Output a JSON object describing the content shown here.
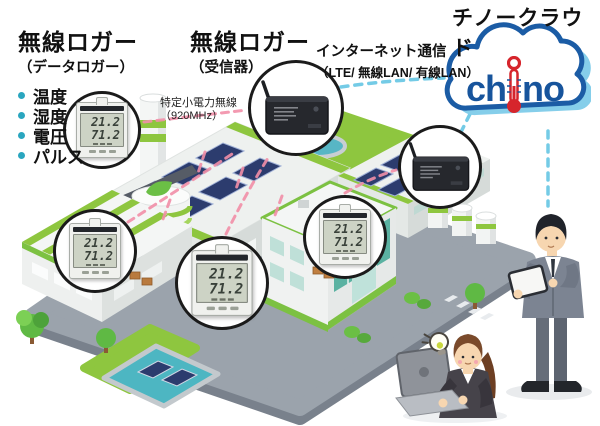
{
  "headings": {
    "cloud_title": "チノークラウド",
    "logger_data_title": "無線ロガー",
    "logger_data_subtitle": "（データロガー）",
    "receiver_title": "無線ロガー",
    "receiver_subtitle": "（受信器）",
    "internet_line1": "インターネット通信",
    "internet_line2": "（LTE/ 無線LAN/ 有線LAN）",
    "radio_line1": "特定小電力無線",
    "radio_line2": "（920MHz）"
  },
  "measurements": [
    {
      "label": "温度"
    },
    {
      "label": "湿度"
    },
    {
      "label": "電圧"
    },
    {
      "label": "パルス"
    }
  ],
  "logo": {
    "prefix": "ch",
    "suffix": "no"
  },
  "logger_display": {
    "temperature": "21.2",
    "humidity": "71.2"
  },
  "factory": {
    "tank_label": "eco"
  },
  "colors": {
    "brand_blue": "#17549c",
    "brand_red": "#d6252c",
    "cloud_shadow": "#85ceea",
    "bullet_teal": "#2aa6bf",
    "wireless_link_pink": "#f28fa8",
    "internet_link_blue": "#74cbe6",
    "factory_green": "#8ec63f",
    "text_black": "#111111"
  }
}
